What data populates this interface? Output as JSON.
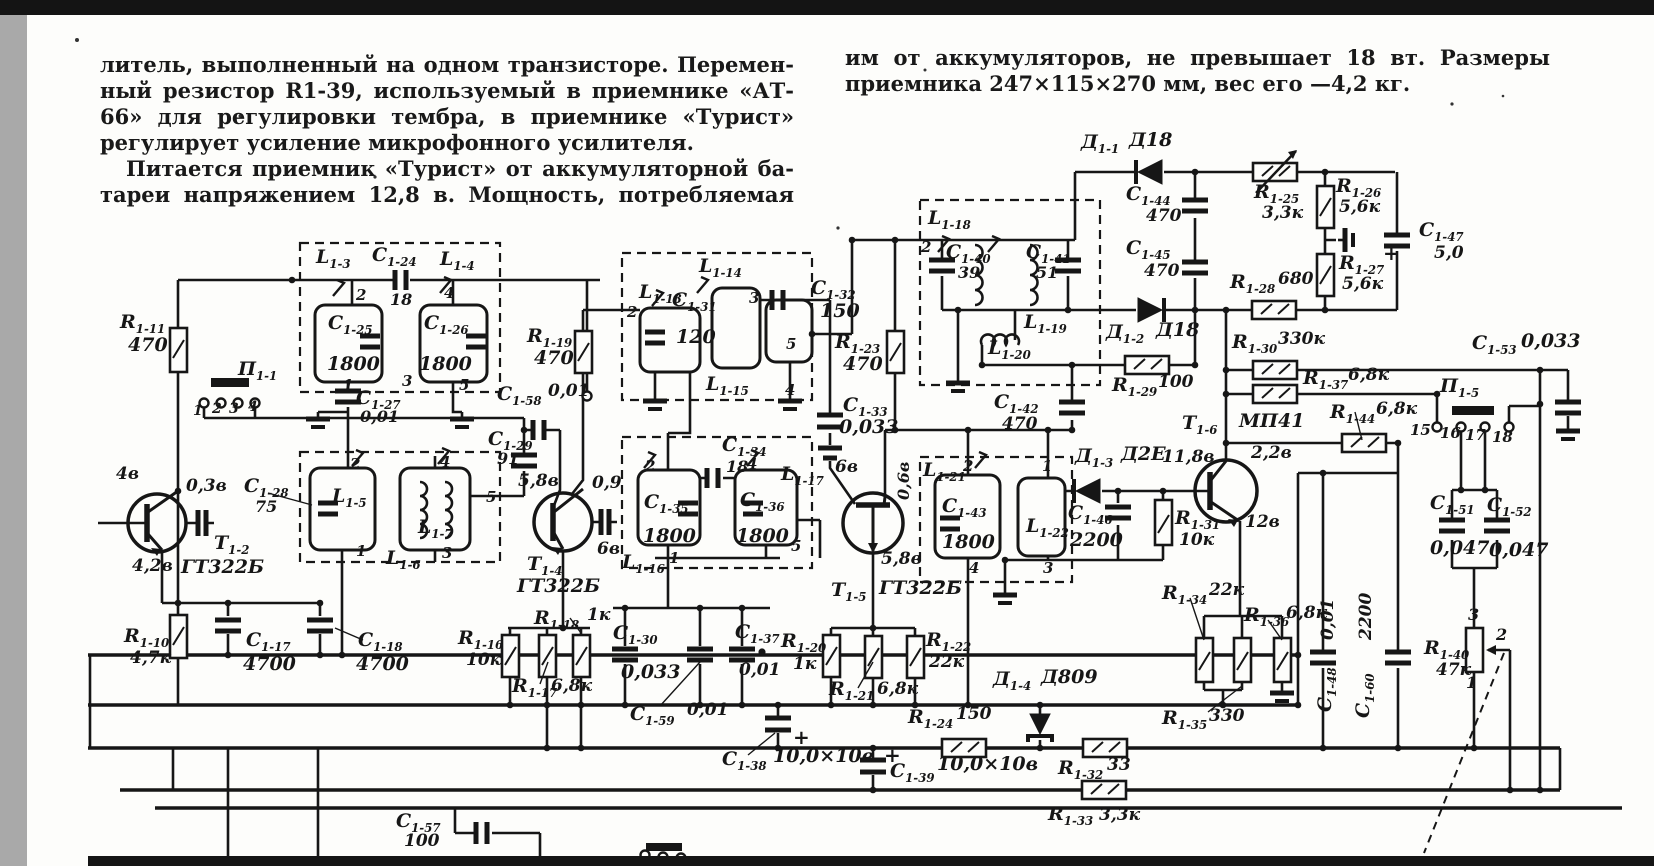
{
  "page": {
    "top_bar_color": "#141414",
    "side_strip_color": "#a9a9a9",
    "paper_color": "#fdfdfb",
    "ink_color": "#1b1b1b"
  },
  "article": {
    "left_column_lines": [
      "литель, выполненный на одном транзисторе. Перемен-",
      "ный резистор R1-39, используемый в приемнике «АТ-",
      "66» для регулировки тембра, в приемнике «Турист»",
      "регулирует усиление микрофонного усилителя.",
      "Питается приемник «Турист» от аккумуляторной ба-",
      "тареи напряжением 12,8 в. Мощность, потребляемая"
    ],
    "right_column_lines": [
      "им от аккумуляторов, не превышает 18 вт. Размеры",
      "приемника 247×115×270 мм, вес его —4,2 кг."
    ]
  },
  "schematic": {
    "labels": [
      {
        "t": "R1-11",
        "x": 120,
        "y": 313
      },
      {
        "t": "470",
        "x": 128,
        "y": 336
      },
      {
        "t": "П1-1",
        "x": 238,
        "y": 360
      },
      {
        "t": "1",
        "x": 193,
        "y": 404,
        "s": 14
      },
      {
        "t": "2",
        "x": 212,
        "y": 402,
        "s": 14
      },
      {
        "t": "3",
        "x": 229,
        "y": 402,
        "s": 14
      },
      {
        "t": "4",
        "x": 248,
        "y": 400,
        "s": 14
      },
      {
        "t": "4в",
        "x": 116,
        "y": 466,
        "s": 17
      },
      {
        "t": "0,3в",
        "x": 186,
        "y": 478,
        "s": 17
      },
      {
        "t": "T1-2",
        "x": 214,
        "y": 534
      },
      {
        "t": "4,2в",
        "x": 132,
        "y": 558,
        "s": 17
      },
      {
        "t": "ГТ322Б",
        "x": 181,
        "y": 558
      },
      {
        "t": "L1-3",
        "x": 316,
        "y": 248
      },
      {
        "t": "C1-24",
        "x": 372,
        "y": 246
      },
      {
        "t": "18",
        "x": 390,
        "y": 292,
        "s": 16
      },
      {
        "t": "L1-4",
        "x": 440,
        "y": 250
      },
      {
        "t": "2",
        "x": 356,
        "y": 288,
        "s": 15
      },
      {
        "t": "4",
        "x": 444,
        "y": 286,
        "s": 15
      },
      {
        "t": "C1-25",
        "x": 328,
        "y": 314
      },
      {
        "t": "1800",
        "x": 327,
        "y": 355
      },
      {
        "t": "C1-26",
        "x": 424,
        "y": 314
      },
      {
        "t": "1800",
        "x": 419,
        "y": 355
      },
      {
        "t": "1",
        "x": 343,
        "y": 378,
        "s": 15
      },
      {
        "t": "3",
        "x": 402,
        "y": 374,
        "s": 15
      },
      {
        "t": "5",
        "x": 459,
        "y": 378,
        "s": 15
      },
      {
        "t": "C1-27",
        "x": 356,
        "y": 389
      },
      {
        "t": "0,01",
        "x": 360,
        "y": 409,
        "s": 16
      },
      {
        "t": "C1-28",
        "x": 244,
        "y": 477
      },
      {
        "t": "75",
        "x": 255,
        "y": 499,
        "s": 16
      },
      {
        "t": "L1-5",
        "x": 332,
        "y": 487
      },
      {
        "t": "L1-6",
        "x": 386,
        "y": 549
      },
      {
        "t": "L1-7",
        "x": 418,
        "y": 518
      },
      {
        "t": "C1-29",
        "x": 488,
        "y": 430
      },
      {
        "t": "91",
        "x": 497,
        "y": 451,
        "s": 16
      },
      {
        "t": "2",
        "x": 350,
        "y": 457,
        "s": 15
      },
      {
        "t": "4",
        "x": 440,
        "y": 455,
        "s": 15
      },
      {
        "t": "1",
        "x": 356,
        "y": 544,
        "s": 15
      },
      {
        "t": "3",
        "x": 442,
        "y": 546,
        "s": 15
      },
      {
        "t": "5",
        "x": 486,
        "y": 490,
        "s": 15
      },
      {
        "t": "C1-58",
        "x": 497,
        "y": 385
      },
      {
        "t": "0,01",
        "x": 548,
        "y": 383,
        "s": 17
      },
      {
        "t": "R1-19",
        "x": 527,
        "y": 327
      },
      {
        "t": "470",
        "x": 534,
        "y": 349
      },
      {
        "t": "5,8в",
        "x": 518,
        "y": 473,
        "s": 17
      },
      {
        "t": "0,9",
        "x": 592,
        "y": 475,
        "s": 17
      },
      {
        "t": "6в",
        "x": 597,
        "y": 541,
        "s": 17
      },
      {
        "t": "T1-4",
        "x": 527,
        "y": 555
      },
      {
        "t": "ГТ322Б",
        "x": 517,
        "y": 577
      },
      {
        "t": "L1-13",
        "x": 639,
        "y": 283
      },
      {
        "t": "2",
        "x": 627,
        "y": 305,
        "s": 15
      },
      {
        "t": "C1-31",
        "x": 672,
        "y": 291
      },
      {
        "t": "120",
        "x": 676,
        "y": 328
      },
      {
        "t": "L1-14",
        "x": 699,
        "y": 257
      },
      {
        "t": "3",
        "x": 749,
        "y": 291,
        "s": 15
      },
      {
        "t": "L1-15",
        "x": 706,
        "y": 375
      },
      {
        "t": "5",
        "x": 786,
        "y": 337,
        "s": 15
      },
      {
        "t": "4",
        "x": 785,
        "y": 383,
        "s": 15
      },
      {
        "t": "C1-32",
        "x": 811,
        "y": 279
      },
      {
        "t": "150",
        "x": 820,
        "y": 302
      },
      {
        "t": "R1-23",
        "x": 835,
        "y": 333
      },
      {
        "t": "470",
        "x": 843,
        "y": 355
      },
      {
        "t": "C1-33",
        "x": 843,
        "y": 396
      },
      {
        "t": "0,033",
        "x": 839,
        "y": 418
      },
      {
        "t": "C1-34",
        "x": 722,
        "y": 436
      },
      {
        "t": "18",
        "x": 726,
        "y": 459,
        "s": 16
      },
      {
        "t": "2",
        "x": 645,
        "y": 459,
        "s": 15
      },
      {
        "t": "4",
        "x": 747,
        "y": 457,
        "s": 15
      },
      {
        "t": "L1-17",
        "x": 781,
        "y": 465
      },
      {
        "t": "C1-35",
        "x": 644,
        "y": 493
      },
      {
        "t": "1800",
        "x": 643,
        "y": 527
      },
      {
        "t": "C1-36",
        "x": 740,
        "y": 491
      },
      {
        "t": "1800",
        "x": 736,
        "y": 527
      },
      {
        "t": "L1-16",
        "x": 622,
        "y": 553
      },
      {
        "t": "1",
        "x": 669,
        "y": 551,
        "s": 15
      },
      {
        "t": "5",
        "x": 791,
        "y": 539,
        "s": 15
      },
      {
        "t": "6в",
        "x": 835,
        "y": 459,
        "s": 17
      },
      {
        "t": "0,6в",
        "x": 896,
        "y": 500,
        "s": 16,
        "r": -90
      },
      {
        "t": "5,8в",
        "x": 881,
        "y": 551,
        "s": 17
      },
      {
        "t": "T1-5",
        "x": 831,
        "y": 581
      },
      {
        "t": "ГТ322Б",
        "x": 879,
        "y": 579
      },
      {
        "t": "R1-20",
        "x": 781,
        "y": 632
      },
      {
        "t": "1к",
        "x": 793,
        "y": 656,
        "s": 17
      },
      {
        "t": "R1-21",
        "x": 829,
        "y": 680
      },
      {
        "t": "6,8к",
        "x": 877,
        "y": 681,
        "s": 17
      },
      {
        "t": "R1-22",
        "x": 926,
        "y": 631
      },
      {
        "t": "22к",
        "x": 929,
        "y": 654,
        "s": 17
      },
      {
        "t": "L1-21",
        "x": 923,
        "y": 461
      },
      {
        "t": "2",
        "x": 963,
        "y": 459,
        "s": 15
      },
      {
        "t": "1",
        "x": 1042,
        "y": 459,
        "s": 15
      },
      {
        "t": "C1-43",
        "x": 942,
        "y": 497
      },
      {
        "t": "1800",
        "x": 942,
        "y": 533
      },
      {
        "t": "L1-22",
        "x": 1026,
        "y": 517
      },
      {
        "t": "4",
        "x": 969,
        "y": 561,
        "s": 15
      },
      {
        "t": "3",
        "x": 1043,
        "y": 561,
        "s": 15
      },
      {
        "t": "Д1-3",
        "x": 1075,
        "y": 447
      },
      {
        "t": "Д2Е",
        "x": 1121,
        "y": 445
      },
      {
        "t": "C1-46",
        "x": 1068,
        "y": 504
      },
      {
        "t": "2200",
        "x": 1070,
        "y": 531
      },
      {
        "t": "R1-31",
        "x": 1175,
        "y": 509
      },
      {
        "t": "10к",
        "x": 1179,
        "y": 532,
        "s": 17
      },
      {
        "t": "Т1-6",
        "x": 1182,
        "y": 414
      },
      {
        "t": "МП41",
        "x": 1239,
        "y": 412
      },
      {
        "t": "11,8в",
        "x": 1162,
        "y": 449,
        "s": 17
      },
      {
        "t": "2,2в",
        "x": 1251,
        "y": 445,
        "s": 17
      },
      {
        "t": "12в",
        "x": 1245,
        "y": 514,
        "s": 17
      },
      {
        "t": "R1-34",
        "x": 1162,
        "y": 584
      },
      {
        "t": "22к",
        "x": 1209,
        "y": 582,
        "s": 17
      },
      {
        "t": "R1-36",
        "x": 1244,
        "y": 606
      },
      {
        "t": "6,8к",
        "x": 1286,
        "y": 605,
        "s": 17
      },
      {
        "t": "R1-35",
        "x": 1162,
        "y": 709
      },
      {
        "t": "330",
        "x": 1209,
        "y": 708,
        "s": 17
      },
      {
        "t": "Д1-4",
        "x": 993,
        "y": 670
      },
      {
        "t": "Д809",
        "x": 1041,
        "y": 668
      },
      {
        "t": "R1-24",
        "x": 908,
        "y": 708
      },
      {
        "t": "150",
        "x": 956,
        "y": 706,
        "s": 17
      },
      {
        "t": "R1-32",
        "x": 1058,
        "y": 759
      },
      {
        "t": "33",
        "x": 1107,
        "y": 757,
        "s": 17
      },
      {
        "t": "R1-33",
        "x": 1048,
        "y": 805
      },
      {
        "t": "3,3к",
        "x": 1099,
        "y": 807,
        "s": 17
      },
      {
        "t": "C1-38",
        "x": 722,
        "y": 750
      },
      {
        "t": "10,0×10в",
        "x": 773,
        "y": 747
      },
      {
        "t": "C1-39",
        "x": 890,
        "y": 762
      },
      {
        "t": "10,0×10в",
        "x": 937,
        "y": 755
      },
      {
        "t": "C1-59",
        "x": 630,
        "y": 705
      },
      {
        "t": "0,01",
        "x": 687,
        "y": 702,
        "s": 17
      },
      {
        "t": "C1-37",
        "x": 735,
        "y": 623
      },
      {
        "t": "0,01",
        "x": 739,
        "y": 662,
        "s": 17
      },
      {
        "t": "C1-30",
        "x": 613,
        "y": 624
      },
      {
        "t": "0,033",
        "x": 621,
        "y": 663
      },
      {
        "t": "R1-18",
        "x": 534,
        "y": 609
      },
      {
        "t": "1к",
        "x": 587,
        "y": 607,
        "s": 17
      },
      {
        "t": "R1-16",
        "x": 458,
        "y": 629
      },
      {
        "t": "10к",
        "x": 466,
        "y": 652,
        "s": 17
      },
      {
        "t": "R1-17",
        "x": 512,
        "y": 677
      },
      {
        "t": "6,8к",
        "x": 551,
        "y": 678,
        "s": 17
      },
      {
        "t": "R1-10",
        "x": 124,
        "y": 627
      },
      {
        "t": "4,7к",
        "x": 130,
        "y": 650,
        "s": 17
      },
      {
        "t": "C1-17",
        "x": 246,
        "y": 631
      },
      {
        "t": "4700",
        "x": 243,
        "y": 655
      },
      {
        "t": "C1-18",
        "x": 358,
        "y": 631
      },
      {
        "t": "4700",
        "x": 356,
        "y": 655
      },
      {
        "t": "C1-57",
        "x": 396,
        "y": 812
      },
      {
        "t": "100",
        "x": 404,
        "y": 833,
        "s": 17
      },
      {
        "t": "Д1-1",
        "x": 1081,
        "y": 133
      },
      {
        "t": "Д18",
        "x": 1129,
        "y": 131
      },
      {
        "t": "C1-44",
        "x": 1126,
        "y": 185
      },
      {
        "t": "470",
        "x": 1146,
        "y": 208,
        "s": 17
      },
      {
        "t": "C1-45",
        "x": 1126,
        "y": 239
      },
      {
        "t": "470",
        "x": 1144,
        "y": 263,
        "s": 17
      },
      {
        "t": "R1-25",
        "x": 1254,
        "y": 183
      },
      {
        "t": "3,3к",
        "x": 1262,
        "y": 205,
        "s": 17
      },
      {
        "t": "R1-26",
        "x": 1336,
        "y": 177
      },
      {
        "t": "5,6к",
        "x": 1339,
        "y": 199,
        "s": 17
      },
      {
        "t": "R1-27",
        "x": 1339,
        "y": 254
      },
      {
        "t": "5,6к",
        "x": 1342,
        "y": 276,
        "s": 17
      },
      {
        "t": "C1-47",
        "x": 1419,
        "y": 221
      },
      {
        "t": "5,0",
        "x": 1434,
        "y": 245,
        "s": 17
      },
      {
        "t": "+",
        "x": 1383,
        "y": 243,
        "s": 20
      },
      {
        "t": "R1-28",
        "x": 1230,
        "y": 273
      },
      {
        "t": "680",
        "x": 1278,
        "y": 271,
        "s": 17
      },
      {
        "t": "Д1-2",
        "x": 1106,
        "y": 323
      },
      {
        "t": "Д18",
        "x": 1156,
        "y": 321
      },
      {
        "t": "R1-29",
        "x": 1112,
        "y": 376
      },
      {
        "t": "100",
        "x": 1158,
        "y": 374,
        "s": 17
      },
      {
        "t": "R1-30",
        "x": 1232,
        "y": 333
      },
      {
        "t": "330к",
        "x": 1278,
        "y": 331,
        "s": 17
      },
      {
        "t": "R1-37",
        "x": 1303,
        "y": 369
      },
      {
        "t": "6,8к",
        "x": 1348,
        "y": 367,
        "s": 17
      },
      {
        "t": "R1-44",
        "x": 1330,
        "y": 403
      },
      {
        "t": "6,8к",
        "x": 1376,
        "y": 401,
        "s": 17
      },
      {
        "t": "П1-5",
        "x": 1440,
        "y": 377
      },
      {
        "t": "15",
        "x": 1410,
        "y": 423,
        "s": 15
      },
      {
        "t": "16",
        "x": 1440,
        "y": 426,
        "s": 15
      },
      {
        "t": "17",
        "x": 1465,
        "y": 428,
        "s": 15
      },
      {
        "t": "18",
        "x": 1492,
        "y": 430,
        "s": 15
      },
      {
        "t": "C1-51",
        "x": 1430,
        "y": 494
      },
      {
        "t": "0,047",
        "x": 1430,
        "y": 539
      },
      {
        "t": "C1-52",
        "x": 1487,
        "y": 496
      },
      {
        "t": "0,047",
        "x": 1489,
        "y": 541
      },
      {
        "t": "C1-53",
        "x": 1472,
        "y": 334
      },
      {
        "t": "0,033",
        "x": 1521,
        "y": 332
      },
      {
        "t": "R1-40",
        "x": 1424,
        "y": 639
      },
      {
        "t": "47к",
        "x": 1436,
        "y": 662,
        "s": 17
      },
      {
        "t": "3",
        "x": 1468,
        "y": 607,
        "s": 16
      },
      {
        "t": "2",
        "x": 1496,
        "y": 627,
        "s": 16
      },
      {
        "t": "1",
        "x": 1466,
        "y": 675,
        "s": 16
      },
      {
        "t": "C1-48",
        "x": 1316,
        "y": 712,
        "r": -90
      },
      {
        "t": "0,01",
        "x": 1320,
        "y": 640,
        "r": -90,
        "s": 17
      },
      {
        "t": "C1-60",
        "x": 1354,
        "y": 718,
        "r": -90
      },
      {
        "t": "2200",
        "x": 1358,
        "y": 640,
        "r": -90,
        "s": 17
      },
      {
        "t": "L1-18",
        "x": 928,
        "y": 209
      },
      {
        "t": "2",
        "x": 921,
        "y": 240,
        "s": 15
      },
      {
        "t": "C1-40",
        "x": 946,
        "y": 243
      },
      {
        "t": "39",
        "x": 958,
        "y": 265,
        "s": 16
      },
      {
        "t": "C1-41",
        "x": 1026,
        "y": 243
      },
      {
        "t": "51",
        "x": 1036,
        "y": 265,
        "s": 16
      },
      {
        "t": "L1-19",
        "x": 1024,
        "y": 313
      },
      {
        "t": "L1-20",
        "x": 988,
        "y": 339
      },
      {
        "t": "C1-42",
        "x": 994,
        "y": 393
      },
      {
        "t": "470",
        "x": 1002,
        "y": 416,
        "s": 17
      },
      {
        "t": "+",
        "x": 793,
        "y": 727,
        "s": 20
      },
      {
        "t": "+",
        "x": 884,
        "y": 745,
        "s": 20
      }
    ]
  }
}
